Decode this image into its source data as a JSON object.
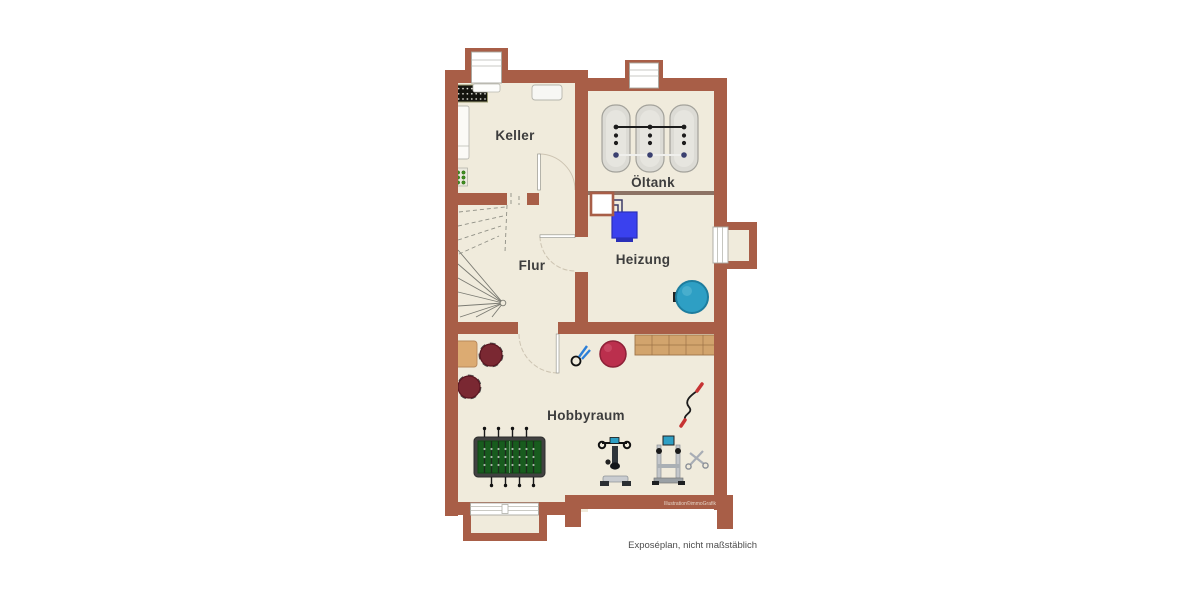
{
  "page": {
    "background": "#ffffff",
    "footer_note": "Exposéplan, nicht maßstäblich",
    "watermark": "Illustration©immoGrafik"
  },
  "floorplan": {
    "type": "basement-floor-plan",
    "rooms": [
      {
        "id": "keller",
        "label": "Keller"
      },
      {
        "id": "oeltank",
        "label": "Öltank"
      },
      {
        "id": "flur",
        "label": "Flur"
      },
      {
        "id": "heizung",
        "label": "Heizung"
      },
      {
        "id": "hobbyraum",
        "label": "Hobbyraum"
      }
    ],
    "objects": [
      "wine-rack",
      "shelf",
      "bottle-crate",
      "cabinet",
      "winder-stairs",
      "oil-tanks",
      "chimney-flue",
      "boiler",
      "heating-pipes",
      "pressure-tank",
      "side-table",
      "stools",
      "foosball-table",
      "exercise-bike",
      "fitness-station",
      "jump-rope",
      "scissors",
      "hand-gripper",
      "sideboard-bench",
      "windows",
      "door-arcs"
    ],
    "colors": {
      "wall": "#a85e47",
      "wall-dark": "#94503c",
      "floor": "#f0ebdc",
      "divider": "#8d7365",
      "boiler-blue": "#3a41ee",
      "tank-teal": "#2e9fc4",
      "ball-red": "#bb2f4d",
      "stool-red": "#7a2832",
      "wood": "#d2a46d",
      "foosball-green": "#185c1e",
      "label-text": "#3d3d3d"
    }
  }
}
